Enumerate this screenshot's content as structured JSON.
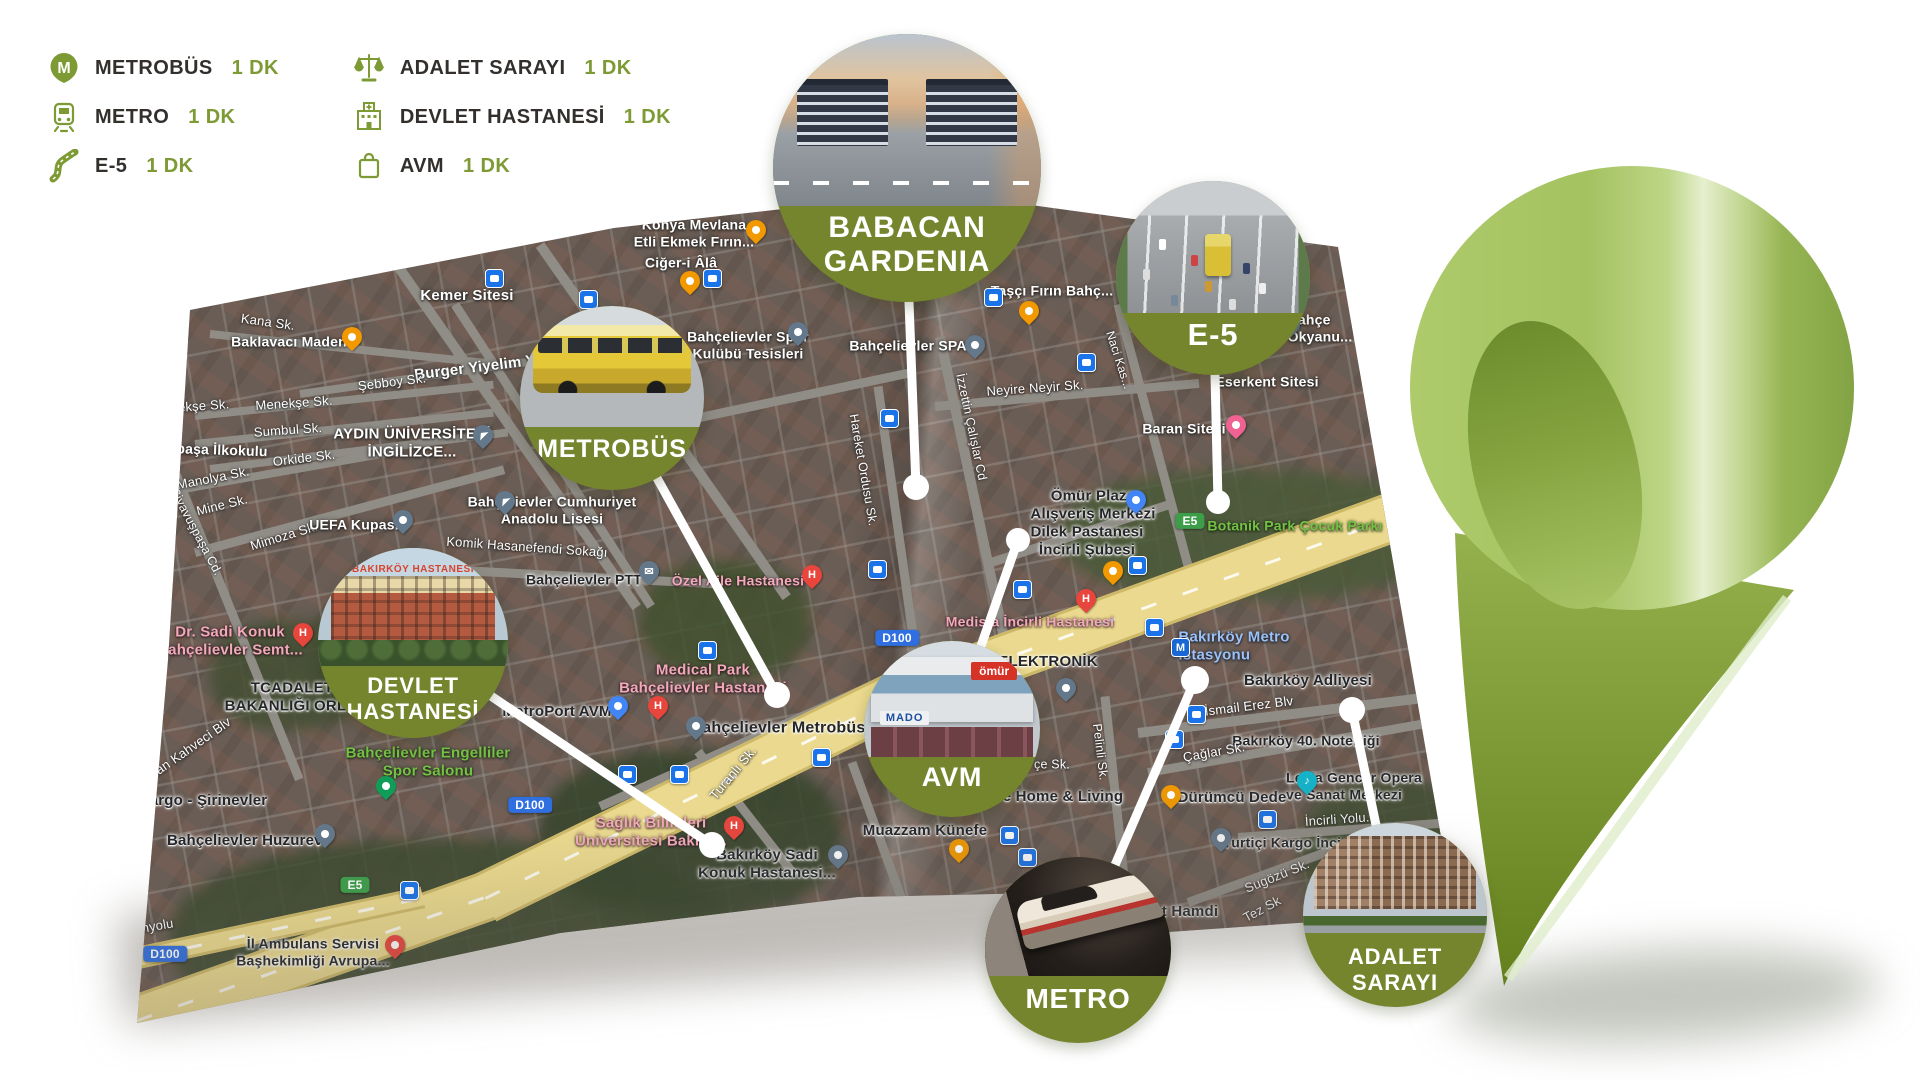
{
  "colors": {
    "olive": "#75852d",
    "legend_accent": "#7d9a34",
    "connector": "#ffffff",
    "pin_light": "#aecb6b",
    "pin_dark": "#64801c",
    "shield_blue": "#2f6fe0",
    "shield_green": "#3d9e4a"
  },
  "legend": {
    "columns": [
      {
        "items": [
          {
            "icon": "metrobus-icon",
            "label": "METROBÜS",
            "time": "1 DK"
          },
          {
            "icon": "metro-icon",
            "label": "METRO",
            "time": "1 DK"
          },
          {
            "icon": "e5-road-icon",
            "label": "E-5",
            "time": "1 DK"
          }
        ]
      },
      {
        "items": [
          {
            "icon": "justice-scales-icon",
            "label": "ADALET SARAYI",
            "time": "1 DK"
          },
          {
            "icon": "hospital-icon",
            "label": "DEVLET HASTANESİ",
            "time": "1 DK"
          },
          {
            "icon": "shopping-bag-icon",
            "label": "AVM",
            "time": "1 DK"
          }
        ]
      }
    ]
  },
  "callouts": [
    {
      "id": "babacan",
      "label": "BABACAN\nGARDENIA",
      "cx": 907,
      "cy": 168,
      "r": 134,
      "font_size": 30,
      "label_top": 66
    },
    {
      "id": "metrobus",
      "label": "METROBÜS",
      "cx": 612,
      "cy": 398,
      "r": 92,
      "font_size": 25,
      "label_top": 70
    },
    {
      "id": "e5",
      "label": "E-5",
      "cx": 1213,
      "cy": 278,
      "r": 97,
      "font_size": 31,
      "label_top": 70
    },
    {
      "id": "devlet",
      "label": "DEVLET\nHASTANESİ",
      "cx": 413,
      "cy": 643,
      "r": 95,
      "font_size": 22,
      "label_top": 66,
      "captions": [
        "BAKIRKÖY HASTANESİ"
      ]
    },
    {
      "id": "avm",
      "label": "AVM",
      "cx": 952,
      "cy": 729,
      "r": 88,
      "font_size": 27,
      "label_top": 69,
      "captions": [
        "ömür",
        "MADO"
      ]
    },
    {
      "id": "metro",
      "label": "METRO",
      "cx": 1078,
      "cy": 950,
      "r": 93,
      "font_size": 28,
      "label_top": 68
    },
    {
      "id": "adalet",
      "label": "ADALET\nSARAYI",
      "cx": 1395,
      "cy": 915,
      "r": 92,
      "font_size": 22,
      "label_top": 66
    }
  ],
  "connectors": [
    {
      "id": "babacan",
      "x1": 909,
      "y1": 302,
      "x2": 916,
      "y2": 487,
      "dot": 13
    },
    {
      "id": "metrobus",
      "x1": 657,
      "y1": 478,
      "x2": 777,
      "y2": 695,
      "dot": 13
    },
    {
      "id": "e5",
      "x1": 1215,
      "y1": 375,
      "x2": 1218,
      "y2": 502,
      "dot": 12
    },
    {
      "id": "devlet",
      "x1": 491,
      "y1": 696,
      "x2": 712,
      "y2": 845,
      "dot": 13
    },
    {
      "id": "avm",
      "x1": 981,
      "y1": 646,
      "x2": 1018,
      "y2": 540,
      "dot": 12
    },
    {
      "id": "metro",
      "x1": 1115,
      "y1": 865,
      "x2": 1195,
      "y2": 680,
      "dot": 14
    },
    {
      "id": "adalet",
      "x1": 1376,
      "y1": 825,
      "x2": 1352,
      "y2": 710,
      "dot": 13
    }
  ],
  "map": {
    "labels": [
      {
        "t": "Kana Sk.",
        "x": 268,
        "y": 322,
        "cls": "street",
        "fs": 13,
        "rot": 8
      },
      {
        "t": "Baklavacı Maden",
        "x": 289,
        "y": 342,
        "cls": "poi",
        "fs": 14
      },
      {
        "t": "Kemer Sitesi",
        "x": 467,
        "y": 296,
        "cls": "poi",
        "fs": 15
      },
      {
        "t": "Burger Yiyelim Y",
        "x": 475,
        "y": 368,
        "cls": "poi",
        "fs": 15,
        "rot": -7
      },
      {
        "t": "Şebboy Sk.",
        "x": 392,
        "y": 382,
        "cls": "street",
        "fs": 13,
        "rot": -7
      },
      {
        "t": "Menekşe Sk.",
        "x": 294,
        "y": 403,
        "cls": "street",
        "fs": 13,
        "rot": -4
      },
      {
        "t": "nekşe Sk.",
        "x": 200,
        "y": 406,
        "cls": "street",
        "fs": 13,
        "rot": -4
      },
      {
        "t": "Sumbul Sk.",
        "x": 288,
        "y": 430,
        "cls": "street",
        "fs": 13,
        "rot": -4
      },
      {
        "t": "AYDIN ÜNİVERSİTESİ\nİNGİLİZCE...",
        "x": 412,
        "y": 443,
        "cls": "poi",
        "fs": 15
      },
      {
        "t": "paşa İlkokulu",
        "x": 222,
        "y": 450,
        "cls": "poi",
        "fs": 14,
        "rot": 2
      },
      {
        "t": "Orkide Sk.",
        "x": 304,
        "y": 458,
        "cls": "street",
        "fs": 13,
        "rot": -7
      },
      {
        "t": "Manolya Sk.",
        "x": 213,
        "y": 478,
        "cls": "street",
        "fs": 13,
        "rot": -11
      },
      {
        "t": "Mine Sk.",
        "x": 222,
        "y": 505,
        "cls": "street",
        "fs": 13,
        "rot": -14
      },
      {
        "t": "Mimoza Sk.",
        "x": 284,
        "y": 536,
        "cls": "street",
        "fs": 13,
        "rot": -17
      },
      {
        "t": "Siyavuşpaşa Cd.",
        "x": 196,
        "y": 532,
        "cls": "street",
        "fs": 12.5,
        "rot": 62
      },
      {
        "t": "UEFA Kupası",
        "x": 354,
        "y": 525,
        "cls": "poi",
        "fs": 14
      },
      {
        "t": "Komik Hasanefendi Sokağı",
        "x": 527,
        "y": 547,
        "cls": "street",
        "fs": 13,
        "rot": 4
      },
      {
        "t": "Bahçelievler Cumhuriyet\nAnadolu Lisesi",
        "x": 552,
        "y": 510,
        "cls": "poi",
        "fs": 14
      },
      {
        "t": "Konya Mevlana\nEtli Ekmek Fırın...",
        "x": 694,
        "y": 233,
        "cls": "poi",
        "fs": 14
      },
      {
        "t": "Ciğer-i Âlâ",
        "x": 681,
        "y": 263,
        "cls": "poi",
        "fs": 14
      },
      {
        "t": "Bahçelievler Spor\nKulübü Tesisleri",
        "x": 748,
        "y": 345,
        "cls": "poi",
        "fs": 14
      },
      {
        "t": "Taşçı Fırın Bahç...",
        "x": 1052,
        "y": 291,
        "cls": "poi",
        "fs": 14
      },
      {
        "t": "Bahçe\nOkyanu...",
        "x": 1320,
        "y": 328,
        "cls": "poi",
        "fs": 14,
        "ta": "l"
      },
      {
        "t": "Eserkent Sitesi",
        "x": 1267,
        "y": 382,
        "cls": "poi",
        "fs": 14
      },
      {
        "t": "Bahçelievler SPA",
        "x": 908,
        "y": 346,
        "cls": "poi",
        "fs": 14
      },
      {
        "t": "Neyire Neyir Sk.",
        "x": 1035,
        "y": 388,
        "cls": "street",
        "fs": 13,
        "rot": -4
      },
      {
        "t": "Naci Kas...",
        "x": 1119,
        "y": 360,
        "cls": "street",
        "fs": 12,
        "rot": 72
      },
      {
        "t": "İzzettin Çalışlar Cd",
        "x": 971,
        "y": 427,
        "cls": "street",
        "fs": 12.5,
        "rot": 78
      },
      {
        "t": "Hareket Ordusu Sk.",
        "x": 863,
        "y": 470,
        "cls": "street",
        "fs": 12.5,
        "rot": 80
      },
      {
        "t": "Baran Sitesi",
        "x": 1184,
        "y": 429,
        "cls": "poi",
        "fs": 14
      },
      {
        "t": "Ömür Plaza\nAlışveriş Merkezi",
        "x": 1093,
        "y": 505,
        "cls": "dark",
        "fs": 15
      },
      {
        "t": "Dilek Pastanesi\nİncirli Şubesi",
        "x": 1087,
        "y": 541,
        "cls": "dark",
        "fs": 15
      },
      {
        "t": "Botanik Park Çocuk Parkı",
        "x": 1295,
        "y": 526,
        "cls": "green",
        "fs": 14
      },
      {
        "t": "E5",
        "x": 1190,
        "y": 521,
        "cls": "shield-green",
        "fs": 12
      },
      {
        "t": "E5",
        "x": 355,
        "y": 885,
        "cls": "shield-green",
        "fs": 12
      },
      {
        "t": "D100",
        "x": 897,
        "y": 638,
        "cls": "shield-blue",
        "fs": 12
      },
      {
        "t": "D100",
        "x": 530,
        "y": 805,
        "cls": "shield-blue",
        "fs": 12
      },
      {
        "t": "D100",
        "x": 165,
        "y": 954,
        "cls": "shield-blue",
        "fs": 12
      },
      {
        "t": "Medista İncirli Hastanesi",
        "x": 1030,
        "y": 622,
        "cls": "pink",
        "fs": 14
      },
      {
        "t": "ELEKTRONİK",
        "x": 1048,
        "y": 662,
        "cls": "dark",
        "fs": 15
      },
      {
        "t": "Bakırköy Metro\nİstasyonu",
        "x": 1234,
        "y": 646,
        "cls": "blue",
        "fs": 15,
        "ta": "l"
      },
      {
        "t": "Bakırköy Adliyesi",
        "x": 1308,
        "y": 681,
        "cls": "dark",
        "fs": 15
      },
      {
        "t": "İsmail Erez Blv",
        "x": 1249,
        "y": 706,
        "cls": "street",
        "fs": 13,
        "rot": -7
      },
      {
        "t": "Bakırköy 40. Noterliği",
        "x": 1306,
        "y": 741,
        "cls": "dark",
        "fs": 14
      },
      {
        "t": "Çağlar Sk.",
        "x": 1214,
        "y": 752,
        "cls": "street",
        "fs": 13,
        "rot": -10
      },
      {
        "t": "Pelinli Sk.",
        "x": 1100,
        "y": 752,
        "cls": "street",
        "fs": 12.5,
        "rot": 83
      },
      {
        "t": "çe Sk.",
        "x": 1052,
        "y": 765,
        "cls": "street",
        "fs": 12.5
      },
      {
        "t": "Leyla Gencer Opera\nve Sanat Merkezi",
        "x": 1354,
        "y": 786,
        "cls": "dark",
        "fs": 14,
        "ta": "l"
      },
      {
        "t": "Dürümcü Dede",
        "x": 1232,
        "y": 798,
        "cls": "dark",
        "fs": 15
      },
      {
        "t": "İncirli Yolu...",
        "x": 1341,
        "y": 819,
        "cls": "street",
        "fs": 13,
        "rot": -4
      },
      {
        "t": "Yurtiçi Kargo İnci...",
        "x": 1288,
        "y": 843,
        "cls": "dark",
        "fs": 14
      },
      {
        "t": "Sugözü Sk.",
        "x": 1277,
        "y": 876,
        "cls": "street",
        "fs": 13,
        "rot": -22
      },
      {
        "t": "Tez Sk",
        "x": 1262,
        "y": 909,
        "cls": "street",
        "fs": 13,
        "rot": -28
      },
      {
        "t": "t Hamdi",
        "x": 1190,
        "y": 912,
        "cls": "dark",
        "fs": 15
      },
      {
        "t": "e Home & Living",
        "x": 1063,
        "y": 797,
        "cls": "dark",
        "fs": 15
      },
      {
        "t": "Muazzam Künefe",
        "x": 925,
        "y": 831,
        "cls": "dark",
        "fs": 15
      },
      {
        "t": "Bakırköy Sadi\nKonuk Hastanesi...",
        "x": 767,
        "y": 864,
        "cls": "dark",
        "fs": 15
      },
      {
        "t": "Sağlık Bilimleri\nÜniversitesi Bakırk...",
        "x": 651,
        "y": 832,
        "cls": "pink",
        "fs": 15
      },
      {
        "t": "Bahçelievler Metrobüs",
        "x": 778,
        "y": 729,
        "cls": "dark",
        "fs": 16
      },
      {
        "t": "Turanlı Sk.",
        "x": 733,
        "y": 773,
        "cls": "street",
        "fs": 13,
        "rot": -50
      },
      {
        "t": "Medical Park\nBahçelievler Hastanesi",
        "x": 703,
        "y": 679,
        "cls": "pink",
        "fs": 15
      },
      {
        "t": "MetroPort AVM",
        "x": 557,
        "y": 712,
        "cls": "dark",
        "fs": 15
      },
      {
        "t": "Bahçelievler PTT",
        "x": 584,
        "y": 580,
        "cls": "dark",
        "fs": 14
      },
      {
        "t": "Özel Aile Hastanesi",
        "x": 738,
        "y": 581,
        "cls": "pink",
        "fs": 14
      },
      {
        "t": "Dr. Sadi Konuk\nBahçelievler Semt...",
        "x": 230,
        "y": 641,
        "cls": "pink",
        "fs": 15
      },
      {
        "t": "TCADALET\nBAKANLIĞI ORL...",
        "x": 292,
        "y": 697,
        "cls": "dark",
        "fs": 15
      },
      {
        "t": "nan Kahveci Blv",
        "x": 190,
        "y": 748,
        "cls": "street",
        "fs": 13,
        "rot": -35
      },
      {
        "t": "Kargo - Şirinevler",
        "x": 203,
        "y": 801,
        "cls": "dark",
        "fs": 15
      },
      {
        "t": "Bahçelievler Huzurevi",
        "x": 247,
        "y": 841,
        "cls": "dark",
        "fs": 15
      },
      {
        "t": "Bahçelievler Engelliler\nSpor Salonu",
        "x": 428,
        "y": 762,
        "cls": "green",
        "fs": 15
      },
      {
        "t": "İl Ambulans Servisi\nBaşhekimliği Avrupa...",
        "x": 313,
        "y": 952,
        "cls": "dark",
        "fs": 14
      },
      {
        "t": "Yanyolu",
        "x": 150,
        "y": 927,
        "cls": "street",
        "fs": 13,
        "rot": -10
      },
      {
        "t": "Fabrika",
        "x": 1424,
        "y": 852,
        "cls": "street",
        "fs": 12.5,
        "rot": -38
      }
    ],
    "pins": [
      {
        "type": "transit",
        "x": 495,
        "y": 281
      },
      {
        "type": "transit",
        "x": 589,
        "y": 302
      },
      {
        "type": "transit",
        "x": 713,
        "y": 281
      },
      {
        "type": "transit",
        "x": 994,
        "y": 300
      },
      {
        "type": "transit",
        "x": 890,
        "y": 421
      },
      {
        "type": "transit",
        "x": 1087,
        "y": 365
      },
      {
        "type": "transit",
        "x": 878,
        "y": 572
      },
      {
        "type": "transit",
        "x": 1023,
        "y": 592
      },
      {
        "type": "transit",
        "x": 1138,
        "y": 568
      },
      {
        "type": "transit",
        "x": 708,
        "y": 653
      },
      {
        "type": "transit",
        "x": 628,
        "y": 777
      },
      {
        "type": "transit",
        "x": 680,
        "y": 777
      },
      {
        "type": "transit",
        "x": 822,
        "y": 760
      },
      {
        "type": "transit",
        "x": 1028,
        "y": 860
      },
      {
        "type": "transit",
        "x": 1155,
        "y": 630
      },
      {
        "type": "transit",
        "x": 1197,
        "y": 717
      },
      {
        "type": "transit",
        "x": 1175,
        "y": 742
      },
      {
        "type": "transit",
        "x": 1268,
        "y": 822
      },
      {
        "type": "transit",
        "x": 1010,
        "y": 838
      },
      {
        "type": "transit",
        "x": 410,
        "y": 893
      },
      {
        "type": "orange",
        "x": 352,
        "y": 339
      },
      {
        "type": "orange",
        "x": 756,
        "y": 232
      },
      {
        "type": "orange",
        "x": 690,
        "y": 283
      },
      {
        "type": "orange",
        "x": 1029,
        "y": 313
      },
      {
        "type": "orange",
        "x": 959,
        "y": 851
      },
      {
        "type": "orange",
        "x": 1171,
        "y": 797
      },
      {
        "type": "orange",
        "x": 1113,
        "y": 573
      },
      {
        "type": "red-h",
        "x": 303,
        "y": 635,
        "ch": "H"
      },
      {
        "type": "red-h",
        "x": 812,
        "y": 577,
        "ch": "H"
      },
      {
        "type": "red-h",
        "x": 658,
        "y": 708,
        "ch": "H"
      },
      {
        "type": "red-h",
        "x": 734,
        "y": 828,
        "ch": "H"
      },
      {
        "type": "red-h",
        "x": 1086,
        "y": 601,
        "ch": "H"
      },
      {
        "type": "slate",
        "x": 975,
        "y": 347
      },
      {
        "type": "slate",
        "x": 798,
        "y": 334
      },
      {
        "type": "slate",
        "x": 403,
        "y": 522
      },
      {
        "type": "slate",
        "x": 838,
        "y": 857
      },
      {
        "type": "slate",
        "x": 1221,
        "y": 840
      },
      {
        "type": "slate",
        "x": 325,
        "y": 836
      },
      {
        "type": "slate",
        "x": 696,
        "y": 728
      },
      {
        "type": "slate",
        "x": 1066,
        "y": 690
      },
      {
        "type": "slate-school",
        "x": 483,
        "y": 437
      },
      {
        "type": "slate-school",
        "x": 505,
        "y": 503
      },
      {
        "type": "slate-school",
        "x": 1290,
        "y": 326
      },
      {
        "type": "slate-mail",
        "x": 649,
        "y": 573,
        "ch": "✉"
      },
      {
        "type": "pink",
        "x": 1236,
        "y": 427
      },
      {
        "type": "teal",
        "x": 1307,
        "y": 783,
        "ch": "♪"
      },
      {
        "type": "green",
        "x": 386,
        "y": 788
      },
      {
        "type": "red",
        "x": 395,
        "y": 947
      },
      {
        "type": "blue-m",
        "x": 1181,
        "y": 650,
        "ch": "M"
      },
      {
        "type": "blue-shop",
        "x": 1136,
        "y": 502
      },
      {
        "type": "blue-shop",
        "x": 618,
        "y": 708
      },
      {
        "type": "red-m",
        "x": 1420,
        "y": 899
      }
    ]
  }
}
